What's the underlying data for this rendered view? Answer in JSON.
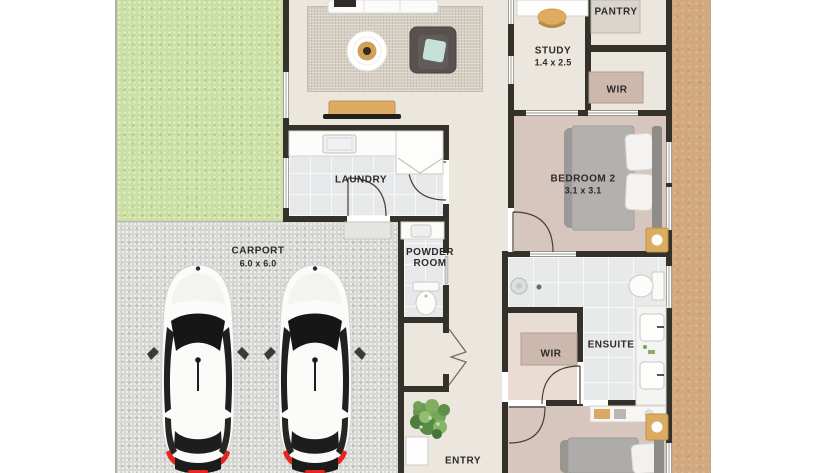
{
  "plan_title": "floor-plan",
  "rooms": {
    "pantry": {
      "name": "PANTRY"
    },
    "study": {
      "name": "STUDY",
      "dimensions": "1.4 x 2.5"
    },
    "wir_upper": {
      "name": "WIR"
    },
    "bedroom2": {
      "name": "BEDROOM 2",
      "dimensions": "3.1 x 3.1"
    },
    "laundry": {
      "name": "LAUNDRY"
    },
    "carport": {
      "name": "CARPORT",
      "dimensions": "6.0 x 6.0"
    },
    "powder_room": {
      "line1": "POWDER",
      "line2": "ROOM"
    },
    "ensuite": {
      "name": "ENSUITE"
    },
    "wir_ensuite": {
      "name": "WIR"
    },
    "entry": {
      "name": "ENTRY"
    }
  },
  "colors": {
    "lawn": "#cbdfa4",
    "concrete": "#d7d7d5",
    "interior_floor": "#ece7de",
    "tile": "#e7e8e9",
    "carpet": "#d7c6be",
    "wall": "#34302a",
    "dirt_path": "#d2a87e",
    "timber": "#dcaa61",
    "taillight_red": "#e6251f",
    "teal_cushion": "#c5e1d9",
    "label_text": "#2d2a27"
  }
}
